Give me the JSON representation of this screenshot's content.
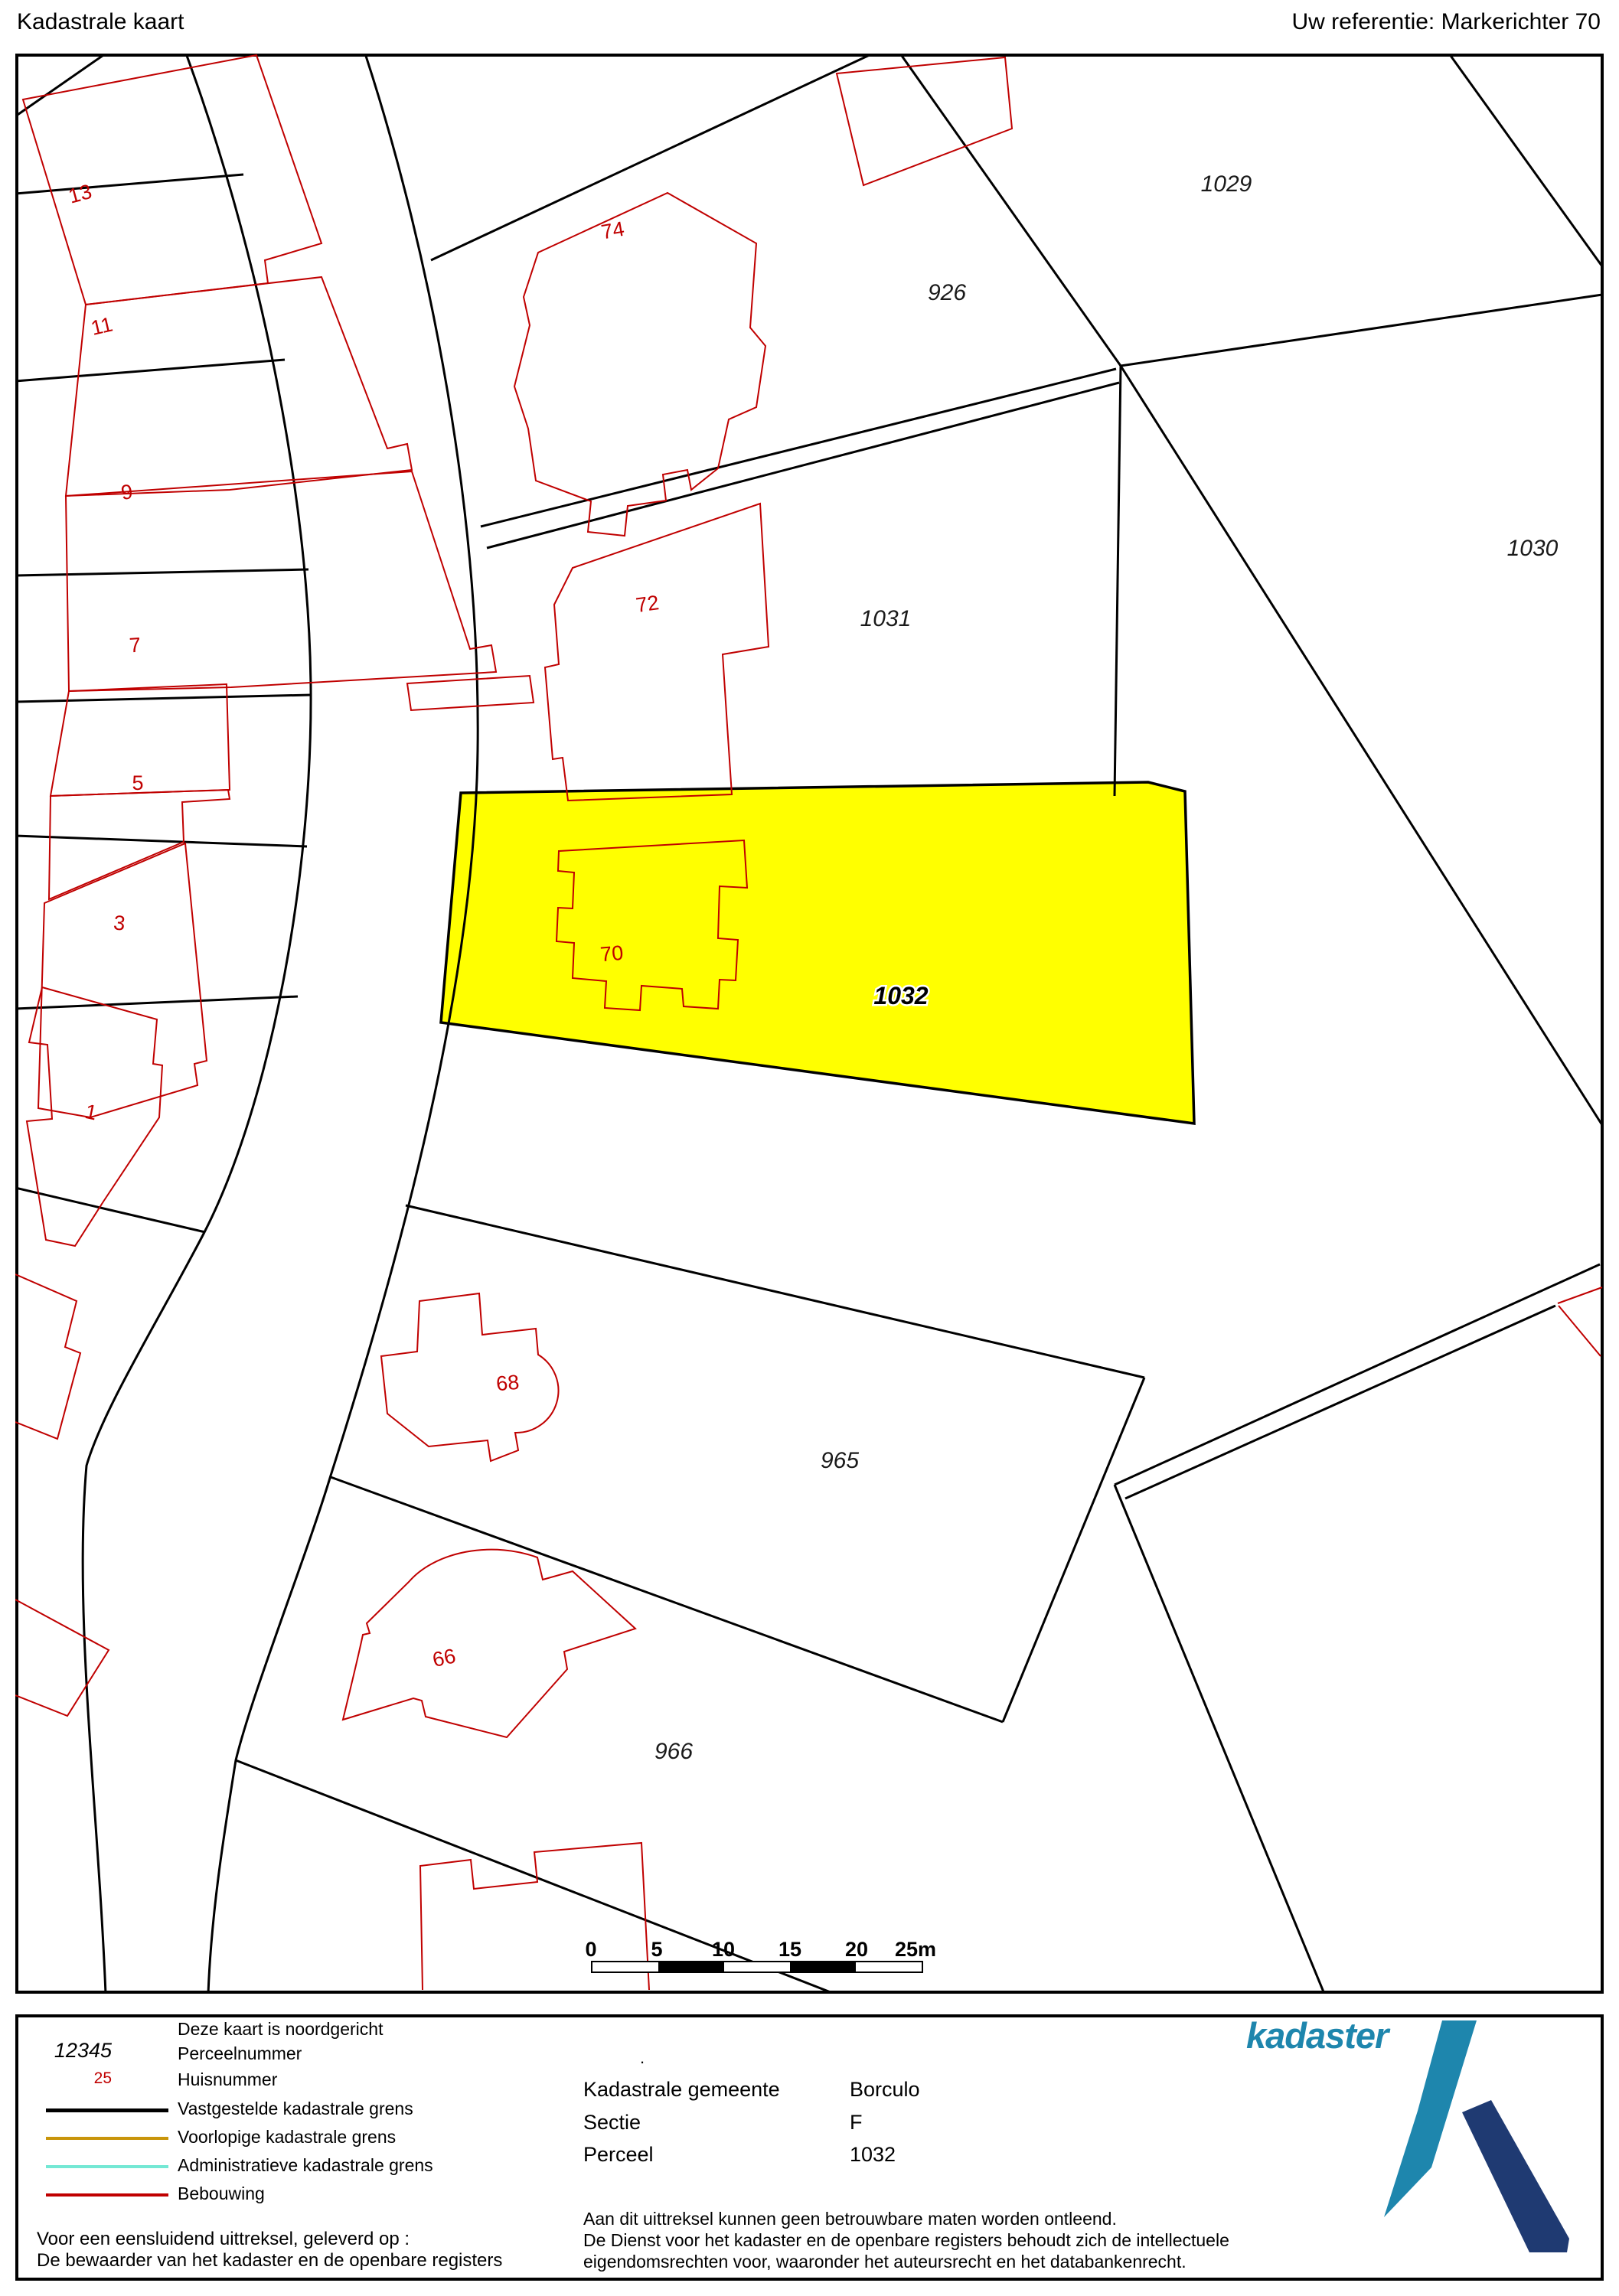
{
  "header": {
    "title": "Kadastrale kaart",
    "reference": "Uw referentie: Markerichter 70"
  },
  "map": {
    "highlight_color": "#ffff00",
    "boundary_color": "#000000",
    "building_color": "#c00000",
    "parcel_numbers": [
      "926",
      "1029",
      "1030",
      "1031",
      "1032",
      "965",
      "966"
    ],
    "house_numbers": [
      "74",
      "72",
      "70",
      "68",
      "66",
      "13",
      "11",
      "9",
      "7",
      "5",
      "3",
      "1"
    ]
  },
  "scale_bar": {
    "labels": [
      "0",
      "5",
      "10",
      "15",
      "20",
      "25m"
    ]
  },
  "legend": {
    "north_note": "Deze kaart is noordgericht",
    "parcel_sample": "12345",
    "parcel_label": "Perceelnummer",
    "house_sample": "25",
    "house_label": "Huisnummer",
    "lines": [
      {
        "label": "Vastgestelde kadastrale grens",
        "color": "#000000"
      },
      {
        "label": "Voorlopige kadastrale grens",
        "color": "#c8950b"
      },
      {
        "label": "Administratieve kadastrale grens",
        "color": "#74e8d4"
      },
      {
        "label": "Bebouwing",
        "color": "#c00000"
      }
    ]
  },
  "info": {
    "rows": [
      {
        "label": "Kadastrale gemeente",
        "value": "Borculo"
      },
      {
        "label": "Sectie",
        "value": "F"
      },
      {
        "label": "Perceel",
        "value": "1032"
      }
    ]
  },
  "footer": {
    "left_line1": "Voor een eensluidend uittreksel, geleverd op :",
    "left_line2": "De bewaarder van het kadaster en de openbare registers",
    "disclaimer1": "Aan dit uittreksel kunnen geen betrouwbare maten worden ontleend.",
    "disclaimer2": "De Dienst voor het kadaster en de openbare registers behoudt zich de intellectuele",
    "disclaimer3": "eigendomsrechten voor, waaronder het auteursrecht en het databankenrecht."
  },
  "logo": {
    "text": "kadaster",
    "teal": "#1e86ad",
    "navy": "#1f3a72"
  },
  "misc": {
    "dot": "."
  }
}
